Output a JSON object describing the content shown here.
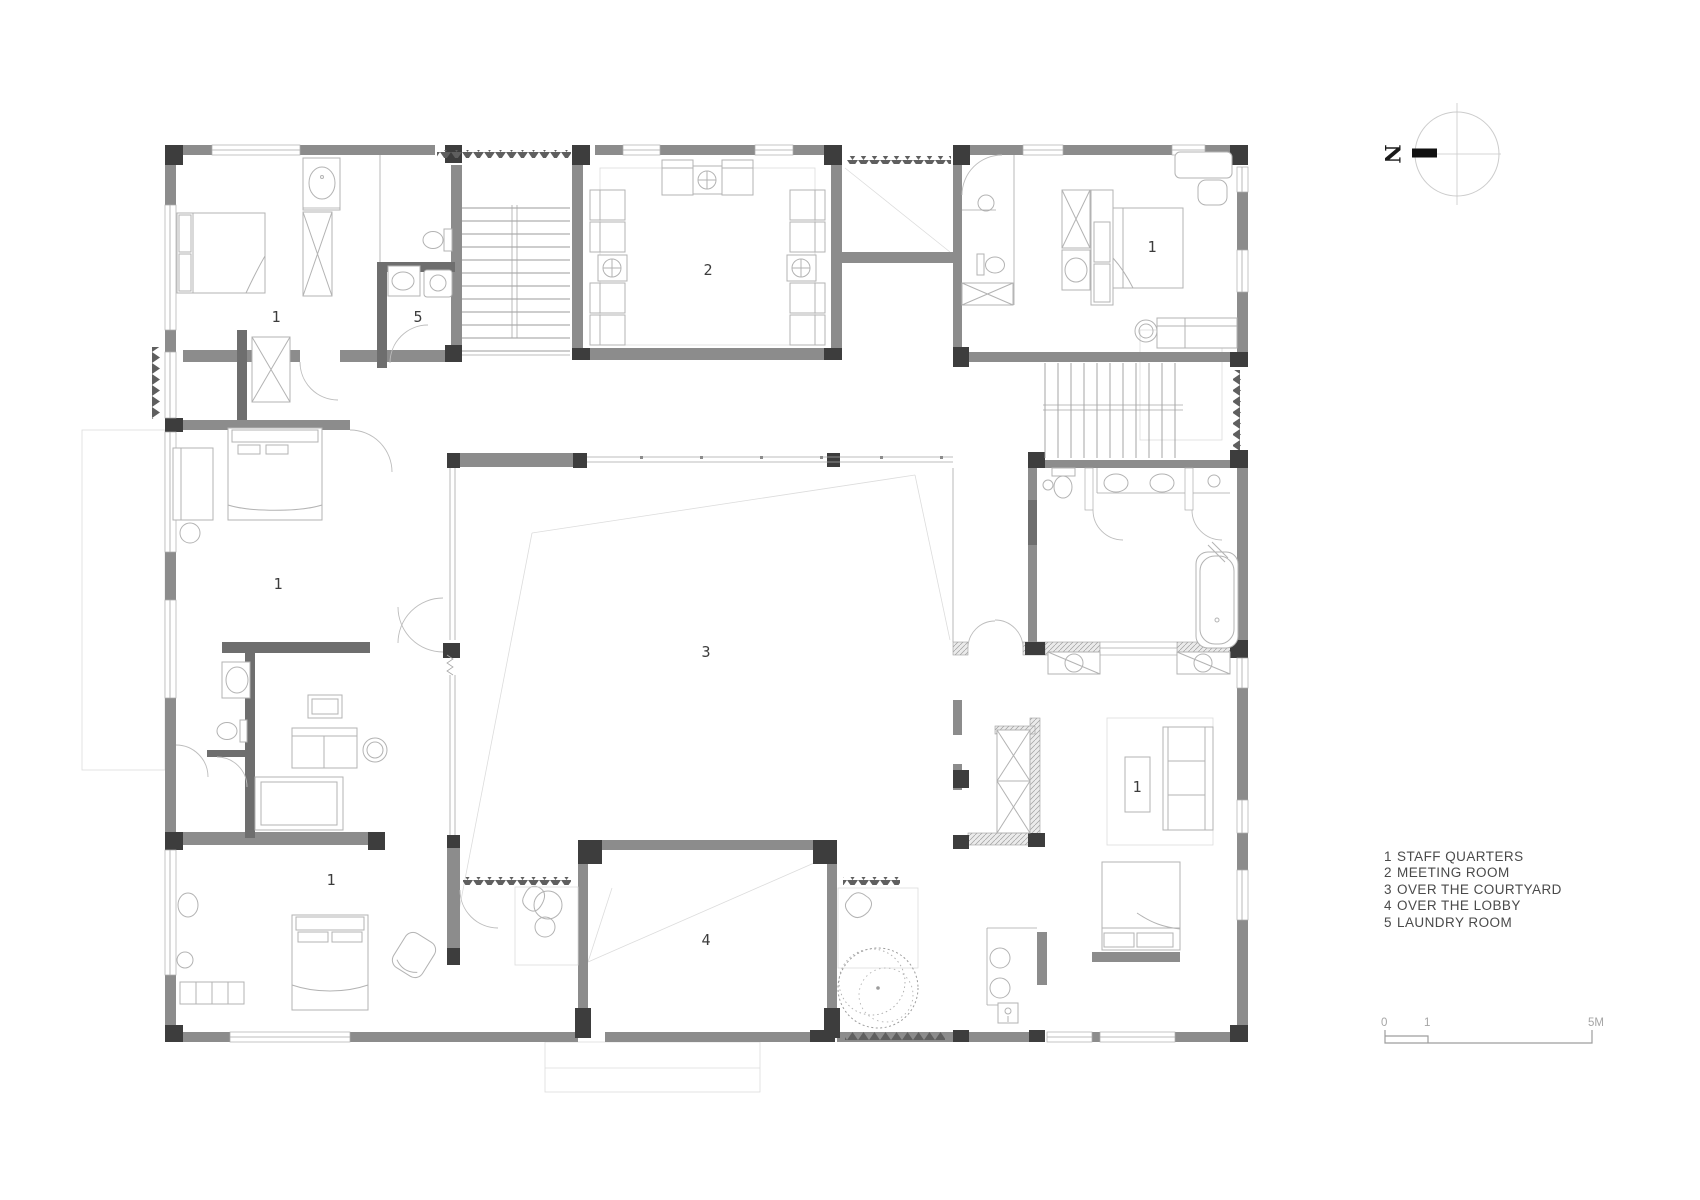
{
  "drawing": {
    "type": "architectural-floor-plan",
    "room_labels": [
      {
        "key": "staff-quarters-top-left",
        "text": "1"
      },
      {
        "key": "laundry-room",
        "text": "5"
      },
      {
        "key": "meeting-room",
        "text": "2"
      },
      {
        "key": "staff-quarters-top-right",
        "text": "1"
      },
      {
        "key": "staff-quarters-mid-left",
        "text": "1"
      },
      {
        "key": "courtyard",
        "text": "3"
      },
      {
        "key": "staff-quarters-bottom-left",
        "text": "1"
      },
      {
        "key": "staff-quarters-bottom-right",
        "text": "1"
      },
      {
        "key": "lobby",
        "text": "4"
      }
    ],
    "legend": [
      {
        "num": "1",
        "label": "STAFF QUARTERS"
      },
      {
        "num": "2",
        "label": "MEETING ROOM"
      },
      {
        "num": "3",
        "label": "OVER THE COURTYARD"
      },
      {
        "num": "4",
        "label": "OVER THE LOBBY"
      },
      {
        "num": "5",
        "label": "LAUNDRY ROOM"
      }
    ],
    "north_label": "N",
    "scale_bar": {
      "tick_0": "0",
      "tick_1": "1",
      "tick_end": "5M"
    },
    "colors": {
      "wall": "#8c8c8c",
      "column": "#3d3d3d",
      "furniture": "#b3b3b3",
      "faint": "#dcdcdc",
      "text": "#3c3c3c"
    }
  }
}
